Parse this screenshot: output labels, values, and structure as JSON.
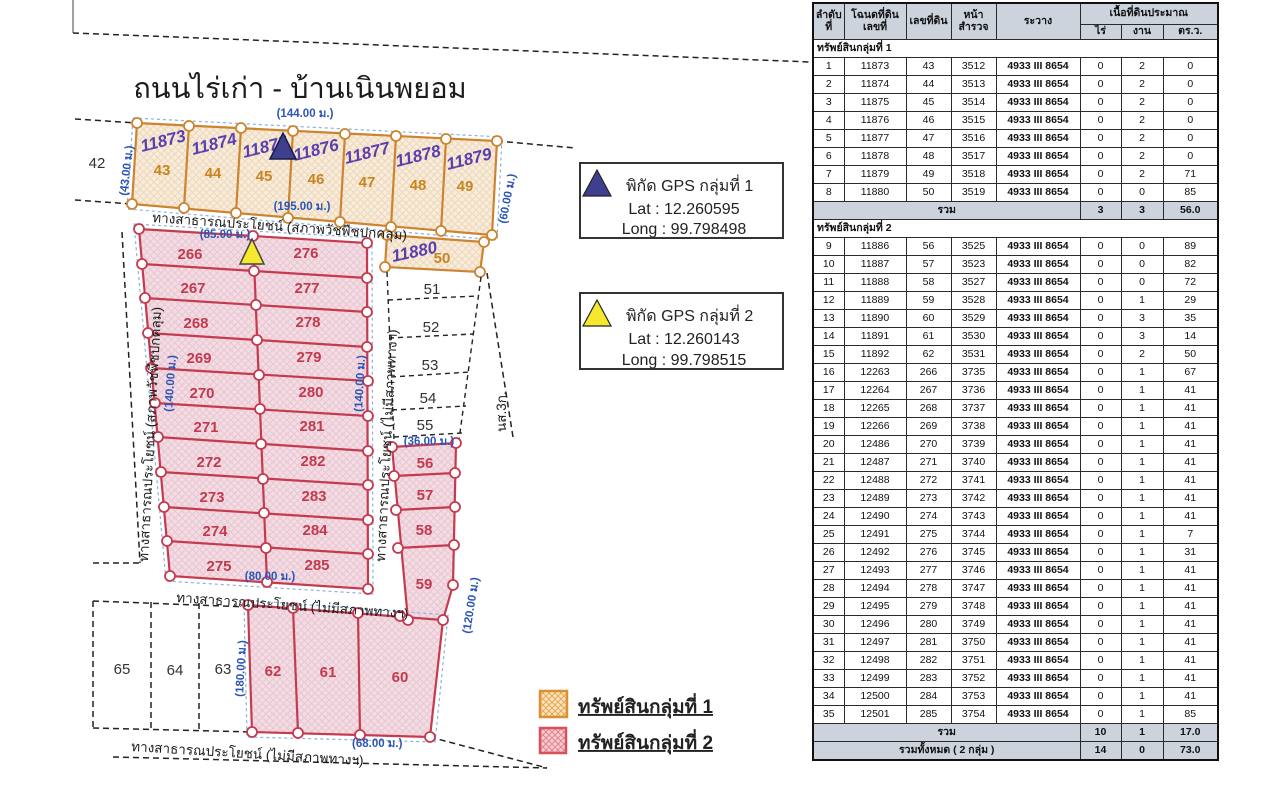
{
  "map": {
    "title": "ถนนไร่เก่า - บ้านเนินพยอม",
    "roads": {
      "covered": "ทางสาธารณประโยชน์ (สภาพวัชพืชปกคลุม)",
      "no_condition": "ทางสาธารณประโยชน์ (ไม่มีสภาพทางฯ)",
      "nso": "นส.3ก."
    },
    "dims": {
      "w144": "(144.00 ม.)",
      "w43": "(43.00 ม.)",
      "w195": "(195.00 ม.)",
      "w60": "(60.00 ม.)",
      "w85": "(85.00 ม.)",
      "w140": "(140.00 ม.)",
      "w80": "(80.00 ม.)",
      "w36": "(36.00 ม.)",
      "w120": "(120.00 ม.)",
      "w180": "(180.00 ม.)",
      "w68": "(68.00 ม.)"
    },
    "neighbor42": "42",
    "top_row": [
      {
        "deed": "11873",
        "no": "43"
      },
      {
        "deed": "11874",
        "no": "44"
      },
      {
        "deed": "11875",
        "no": "45"
      },
      {
        "deed": "11876",
        "no": "46"
      },
      {
        "deed": "11877",
        "no": "47"
      },
      {
        "deed": "11878",
        "no": "48"
      },
      {
        "deed": "11879",
        "no": "49"
      }
    ],
    "plot50": {
      "deed": "11880",
      "no": "50"
    },
    "strip": [
      "51",
      "52",
      "53",
      "54",
      "55"
    ],
    "pink_left": [
      "266",
      "267",
      "268",
      "269",
      "270",
      "271",
      "272",
      "273",
      "274",
      "275"
    ],
    "pink_right": [
      "276",
      "277",
      "278",
      "279",
      "280",
      "281",
      "282",
      "283",
      "284",
      "285"
    ],
    "pink_col": [
      "56",
      "57",
      "58",
      "59"
    ],
    "bottom_row": [
      "62",
      "61",
      "60"
    ],
    "bottom_dashed": [
      "65",
      "64",
      "63"
    ]
  },
  "gps1": {
    "title": "พิกัด GPS กลุ่มที่ 1",
    "lat": "Lat : 12.260595",
    "long": "Long : 99.798498"
  },
  "gps2": {
    "title": "พิกัด GPS กลุ่มที่ 2",
    "lat": "Lat : 12.260143",
    "long": "Long : 99.798515"
  },
  "legend": {
    "item1": "ทรัพย์สินกลุ่มที่ 1",
    "item2": "ทรัพย์สินกลุ่มที่ 2",
    "color1": "#dd8f33",
    "color2": "#d94f5c"
  },
  "table": {
    "h_no": "ลำดับ\nที่",
    "h_deed": "โฉนดที่ดิน\nเลขที่",
    "h_plot": "เลขที่ดิน",
    "h_page": "หน้า\nสำรวจ",
    "h_ravang": "ระวาง",
    "h_area": "เนื้อที่ดินประมาณ",
    "h_rai": "ไร่",
    "h_ngan": "งาน",
    "h_wa": "ตร.ว.",
    "total_label": "รวม",
    "sections": [
      {
        "title": "ทรัพย์สินกลุ่มที่ 1",
        "rows": [
          [
            "1",
            "11873",
            "43",
            "3512",
            "4933 III 8654",
            "0",
            "2",
            "0"
          ],
          [
            "2",
            "11874",
            "44",
            "3513",
            "4933 III 8654",
            "0",
            "2",
            "0"
          ],
          [
            "3",
            "11875",
            "45",
            "3514",
            "4933 III 8654",
            "0",
            "2",
            "0"
          ],
          [
            "4",
            "11876",
            "46",
            "3515",
            "4933 III 8654",
            "0",
            "2",
            "0"
          ],
          [
            "5",
            "11877",
            "47",
            "3516",
            "4933 III 8654",
            "0",
            "2",
            "0"
          ],
          [
            "6",
            "11878",
            "48",
            "3517",
            "4933 III 8654",
            "0",
            "2",
            "0"
          ],
          [
            "7",
            "11879",
            "49",
            "3518",
            "4933 III 8654",
            "0",
            "2",
            "71"
          ],
          [
            "8",
            "11880",
            "50",
            "3519",
            "4933 III 8654",
            "0",
            "0",
            "85"
          ]
        ],
        "total": {
          "rai": "3",
          "ngan": "3",
          "wa": "56.0"
        }
      },
      {
        "title": "ทรัพย์สินกลุ่มที่ 2",
        "rows": [
          [
            "9",
            "11886",
            "56",
            "3525",
            "4933 III 8654",
            "0",
            "0",
            "89"
          ],
          [
            "10",
            "11887",
            "57",
            "3523",
            "4933 III 8654",
            "0",
            "0",
            "82"
          ],
          [
            "11",
            "11888",
            "58",
            "3527",
            "4933 III 8654",
            "0",
            "0",
            "72"
          ],
          [
            "12",
            "11889",
            "59",
            "3528",
            "4933 III 8654",
            "0",
            "1",
            "29"
          ],
          [
            "13",
            "11890",
            "60",
            "3529",
            "4933 III 8654",
            "0",
            "3",
            "35"
          ],
          [
            "14",
            "11891",
            "61",
            "3530",
            "4933 III 8654",
            "0",
            "3",
            "14"
          ],
          [
            "15",
            "11892",
            "62",
            "3531",
            "4933 III 8654",
            "0",
            "2",
            "50"
          ],
          [
            "16",
            "12263",
            "266",
            "3735",
            "4933 III 8654",
            "0",
            "1",
            "67"
          ],
          [
            "17",
            "12264",
            "267",
            "3736",
            "4933 III 8654",
            "0",
            "1",
            "41"
          ],
          [
            "18",
            "12265",
            "268",
            "3737",
            "4933 III 8654",
            "0",
            "1",
            "41"
          ],
          [
            "19",
            "12266",
            "269",
            "3738",
            "4933 III 8654",
            "0",
            "1",
            "41"
          ],
          [
            "20",
            "12486",
            "270",
            "3739",
            "4933 III 8654",
            "0",
            "1",
            "41"
          ],
          [
            "21",
            "12487",
            "271",
            "3740",
            "4933 III 8654",
            "0",
            "1",
            "41"
          ],
          [
            "22",
            "12488",
            "272",
            "3741",
            "4933 III 8654",
            "0",
            "1",
            "41"
          ],
          [
            "23",
            "12489",
            "273",
            "3742",
            "4933 III 8654",
            "0",
            "1",
            "41"
          ],
          [
            "24",
            "12490",
            "274",
            "3743",
            "4933 III 8654",
            "0",
            "1",
            "41"
          ],
          [
            "25",
            "12491",
            "275",
            "3744",
            "4933 III 8654",
            "0",
            "1",
            "7"
          ],
          [
            "26",
            "12492",
            "276",
            "3745",
            "4933 III 8654",
            "0",
            "1",
            "31"
          ],
          [
            "27",
            "12493",
            "277",
            "3746",
            "4933 III 8654",
            "0",
            "1",
            "41"
          ],
          [
            "28",
            "12494",
            "278",
            "3747",
            "4933 III 8654",
            "0",
            "1",
            "41"
          ],
          [
            "29",
            "12495",
            "279",
            "3748",
            "4933 III 8654",
            "0",
            "1",
            "41"
          ],
          [
            "30",
            "12496",
            "280",
            "3749",
            "4933 III 8654",
            "0",
            "1",
            "41"
          ],
          [
            "31",
            "12497",
            "281",
            "3750",
            "4933 III 8654",
            "0",
            "1",
            "41"
          ],
          [
            "32",
            "12498",
            "282",
            "3751",
            "4933 III 8654",
            "0",
            "1",
            "41"
          ],
          [
            "33",
            "12499",
            "283",
            "3752",
            "4933 III 8654",
            "0",
            "1",
            "41"
          ],
          [
            "34",
            "12500",
            "284",
            "3753",
            "4933 III 8654",
            "0",
            "1",
            "41"
          ],
          [
            "35",
            "12501",
            "285",
            "3754",
            "4933 III 8654",
            "0",
            "1",
            "85"
          ]
        ],
        "total": {
          "rai": "10",
          "ngan": "1",
          "wa": "17.0"
        }
      }
    ],
    "grand_total": {
      "label": "รวมทั้งหมด  ( 2 กลุ่ม )",
      "rai": "14",
      "ngan": "0",
      "wa": "73.0"
    }
  }
}
